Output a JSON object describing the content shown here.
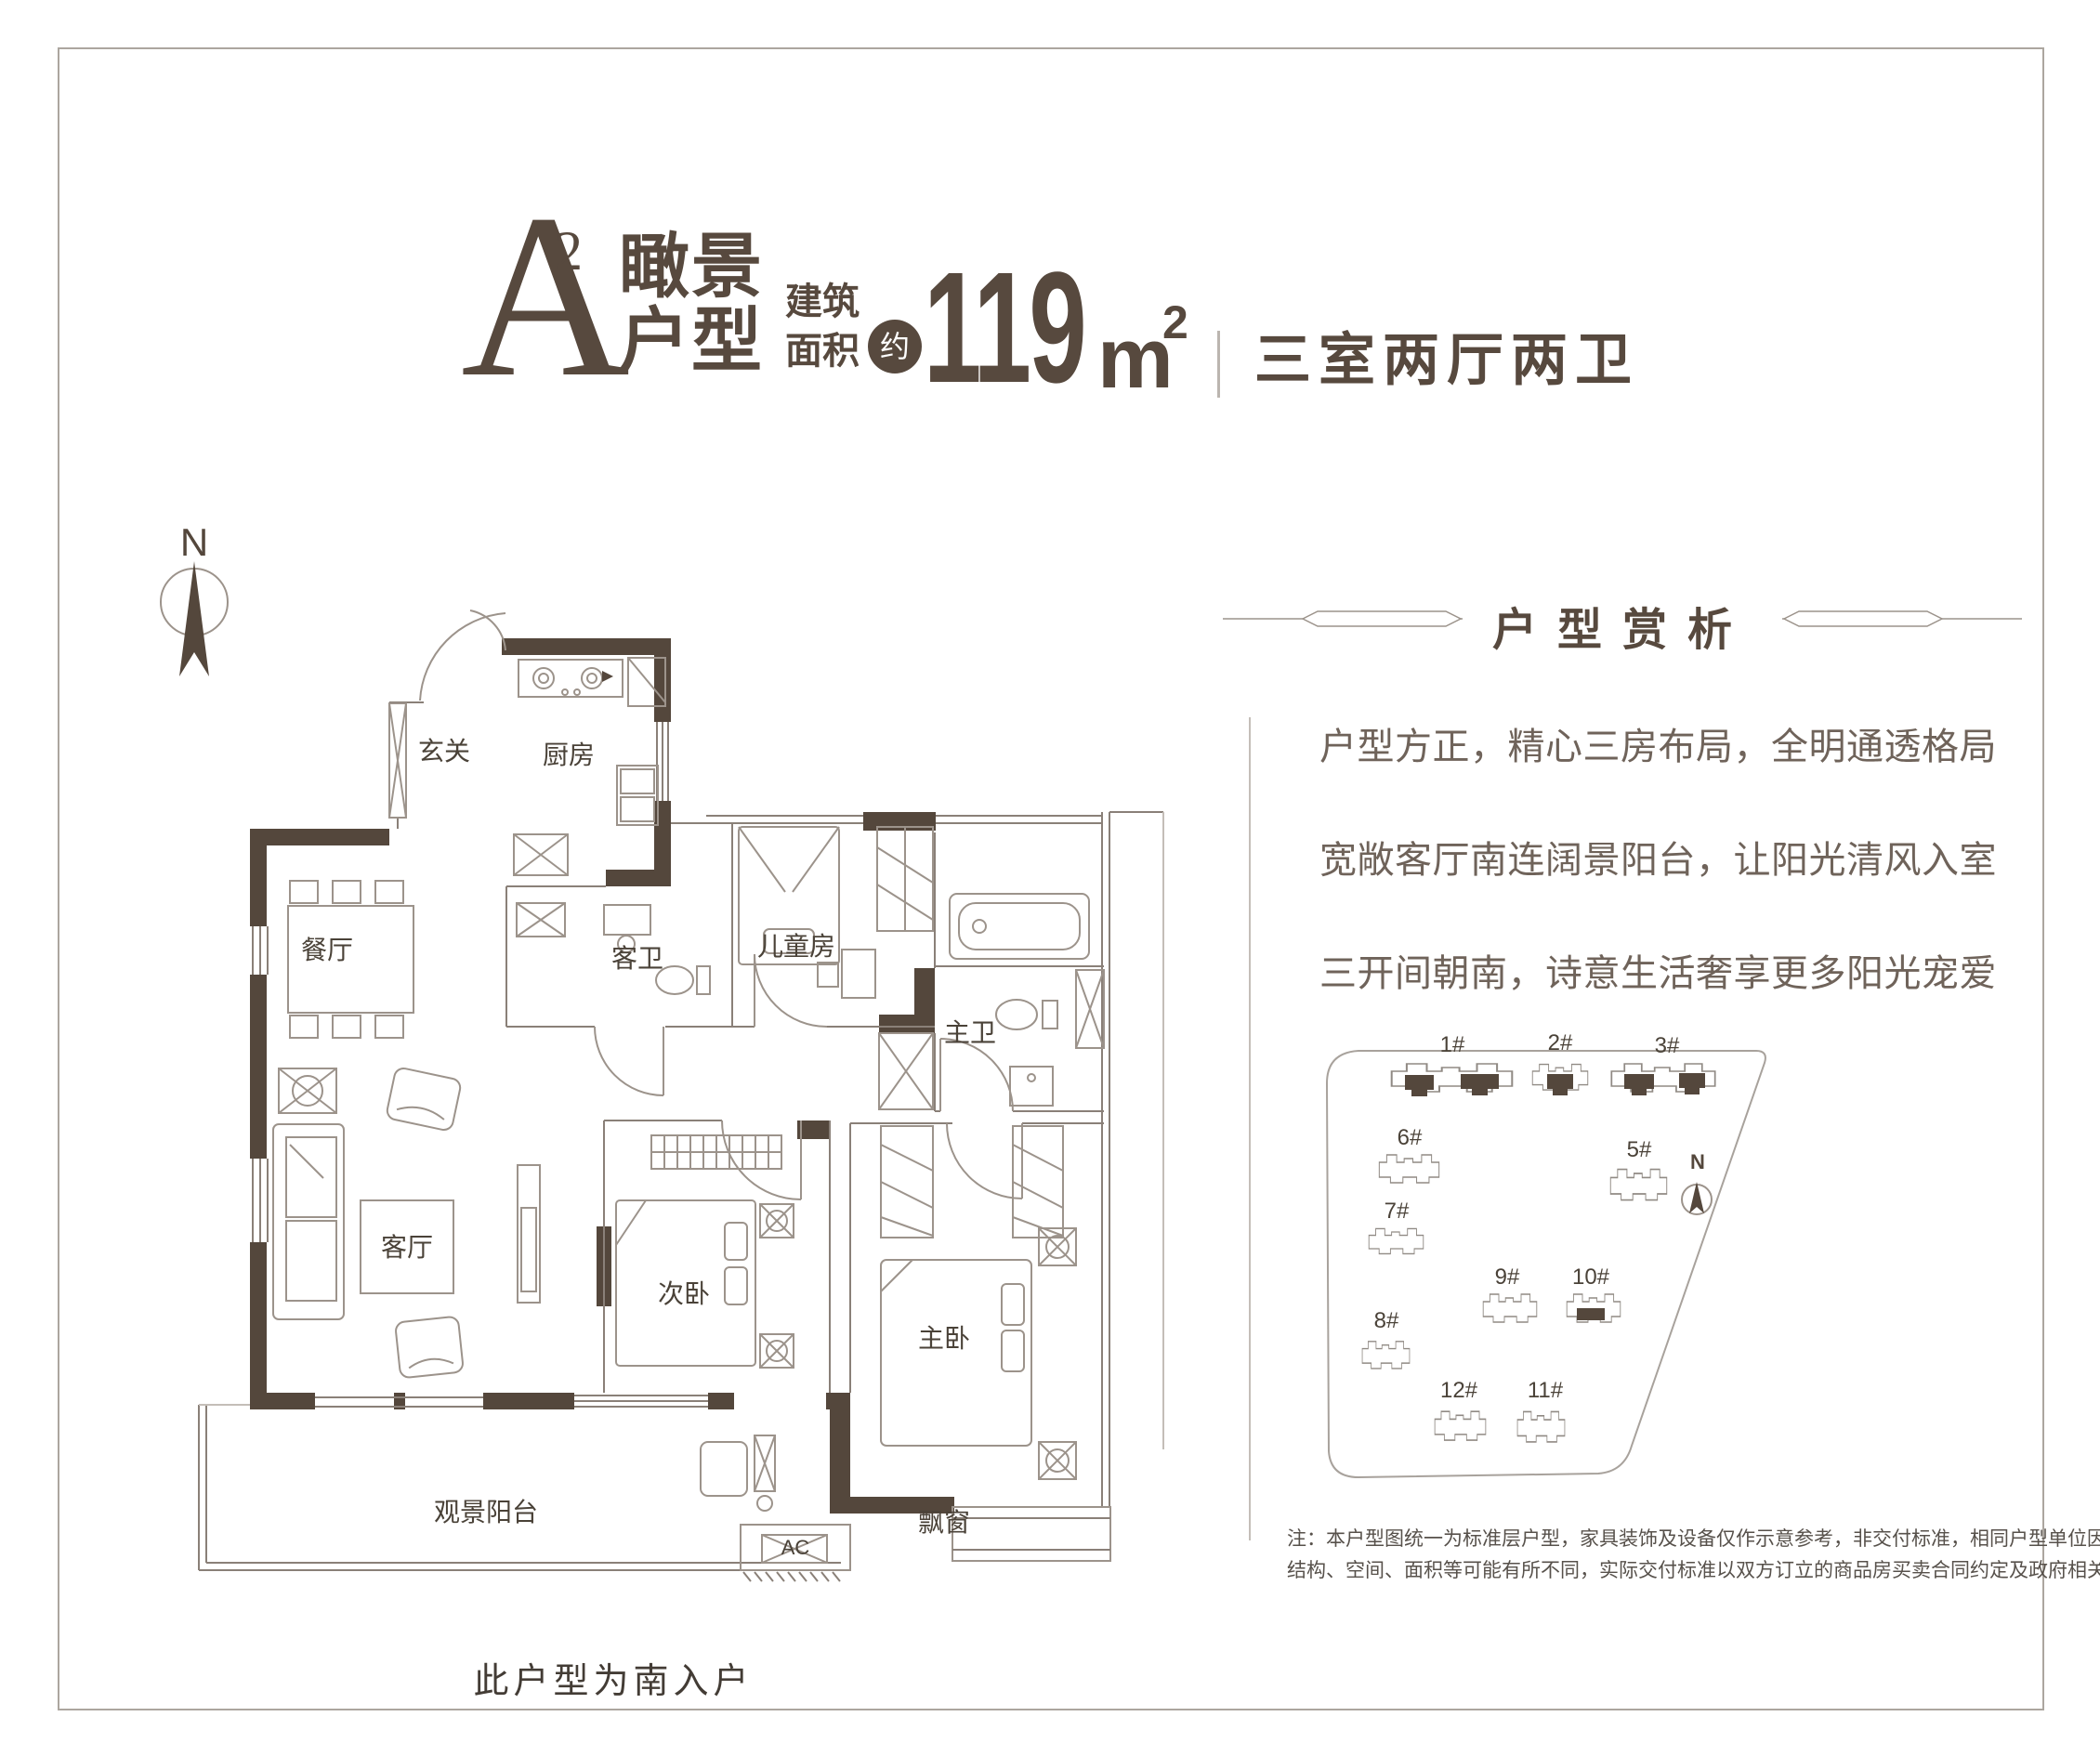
{
  "colors": {
    "accent_dark": "#57493E",
    "wall": "#54473C",
    "thin_line": "#8A8078",
    "furniture_line": "#9C938B",
    "frame_border": "#ACA69F",
    "paragraph_text": "#6F635A"
  },
  "header": {
    "letter": "A",
    "letter_sup": "2",
    "name_line1": "瞰景",
    "name_line2": "户型",
    "area_label_line1": "建筑",
    "area_label_line2": "面积",
    "approx": "约",
    "area_value": "119",
    "area_unit": "m",
    "area_unit_sup": "2",
    "layout_desc": "三室两厅两卫"
  },
  "floor_plan": {
    "north": "N",
    "rooms": [
      {
        "label": "玄关"
      },
      {
        "label": "厨房"
      },
      {
        "label": "餐厅"
      },
      {
        "label": "客卫"
      },
      {
        "label": "儿童房"
      },
      {
        "label": "主卫"
      },
      {
        "label": "客厅"
      },
      {
        "label": "次卧"
      },
      {
        "label": "主卧"
      }
    ],
    "balcony": "观景阳台",
    "bay_window": "飘窗",
    "ac": "AC",
    "caption": "此户型为南入户"
  },
  "analysis": {
    "title": "户型赏析",
    "paragraphs": [
      "户型方正，精心三房布局，全明通透格局",
      "宽敞客厅南连阔景阳台，让阳光清风入室",
      "三开间朝南，诗意生活奢享更多阳光宠爱"
    ]
  },
  "site_plan": {
    "north": "N",
    "buildings": [
      {
        "label": "1#",
        "highlighted": true
      },
      {
        "label": "2#",
        "highlighted": true
      },
      {
        "label": "3#",
        "highlighted": true
      },
      {
        "label": "6#",
        "highlighted": false
      },
      {
        "label": "5#",
        "highlighted": false
      },
      {
        "label": "7#",
        "highlighted": false
      },
      {
        "label": "9#",
        "highlighted": false
      },
      {
        "label": "10#",
        "highlighted": true
      },
      {
        "label": "8#",
        "highlighted": false
      },
      {
        "label": "12#",
        "highlighted": false
      },
      {
        "label": "11#",
        "highlighted": false
      }
    ]
  },
  "disclaimer": {
    "line1": "注：本户型图统一为标准层户型，家具装饰及设备仅作示意参考，非交付标准，相同户型单位因楼层、单位等差别，",
    "line2": "结构、空间、面积等可能有所不同，实际交付标准以双方订立的商品房买卖合同约定及政府相关文件为准。"
  }
}
